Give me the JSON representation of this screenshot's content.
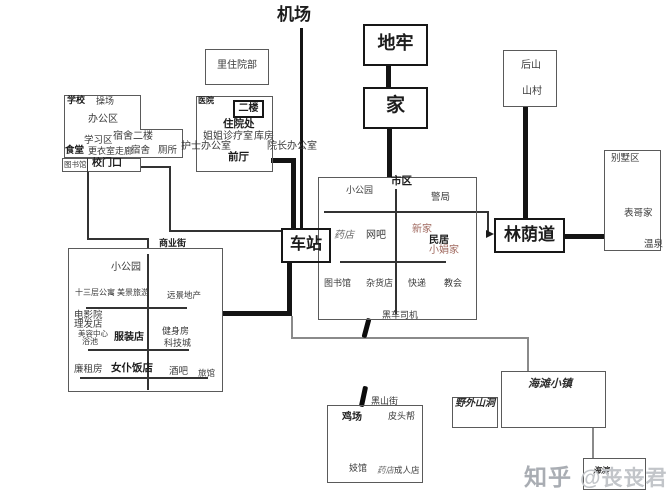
{
  "nodes": {
    "airport": "机场",
    "inpatient_dept": "里住院部",
    "school": {
      "title": "学校",
      "playground": "操场",
      "office_area": "办公区",
      "study_area": "学习区",
      "canteen": "食堂",
      "changing_corridor": "更衣室走廊",
      "dorm_second_floor": "宿舍二楼",
      "dorm": "宿舍",
      "toilet": "厕所",
      "library": "图书馆",
      "gate": "校门口"
    },
    "hospital": {
      "title": "医院",
      "second_floor": "二楼",
      "inpatient_office": "住院处",
      "sister_clinic": "姐姐诊疗室",
      "storeroom": "库房",
      "nurse_office": "护士办公室",
      "dean_office": "院长办公室",
      "front_hall": "前厅"
    },
    "dungeon": "地牢",
    "home": "家",
    "back_hill": {
      "hill": "后山",
      "village": "山村"
    },
    "villa_area": {
      "title": "别墅区",
      "cousin_house": "表哥家",
      "hot_spring": "温泉"
    },
    "downtown": {
      "title": "市区",
      "small_park": "小公园",
      "police_station": "警局",
      "pharmacy": "药店",
      "internet_cafe": "网吧",
      "new_home": "新家",
      "residence": "民居",
      "xiaojuan_home": "小娟家",
      "library": "图书馆",
      "grocery": "杂货店",
      "express": "快递",
      "church": "教会",
      "black_car_driver": "黑车司机"
    },
    "station": "车站",
    "boulevard": "林荫道",
    "commercial_street": {
      "title": "商业街",
      "small_park": "小公园",
      "apartment_13f": "十三层公寓",
      "scenic_travel": "美景旅游",
      "vision_realty": "远景地产",
      "cinema": "电影院",
      "barber_shop": "理发店",
      "beauty_center": "美容中心",
      "bath_house": "浴池",
      "clothing_shop": "服装店",
      "gym": "健身房",
      "tech_city": "科技城",
      "low_rent_house": "廉租房",
      "maid_restaurant": "女仆饭店",
      "bar": "酒吧",
      "inn": "旅馆"
    },
    "black_hill_street": "黑山街",
    "south_town": {
      "chicken_farm": "鸡场",
      "pitou_gang": "皮头帮",
      "brothel": "妓馆",
      "pharmacy": "药店",
      "adult_shop": "成人店"
    },
    "wild_cave": "野外山洞",
    "beach_town": "海滩小镇",
    "seaside": "海滨"
  },
  "watermark": {
    "brand": "知乎",
    "author": "@丧丧君"
  },
  "colors": {
    "accent_red": "#a0695f",
    "line": "#141414",
    "watermark": "#c2c5c9"
  }
}
